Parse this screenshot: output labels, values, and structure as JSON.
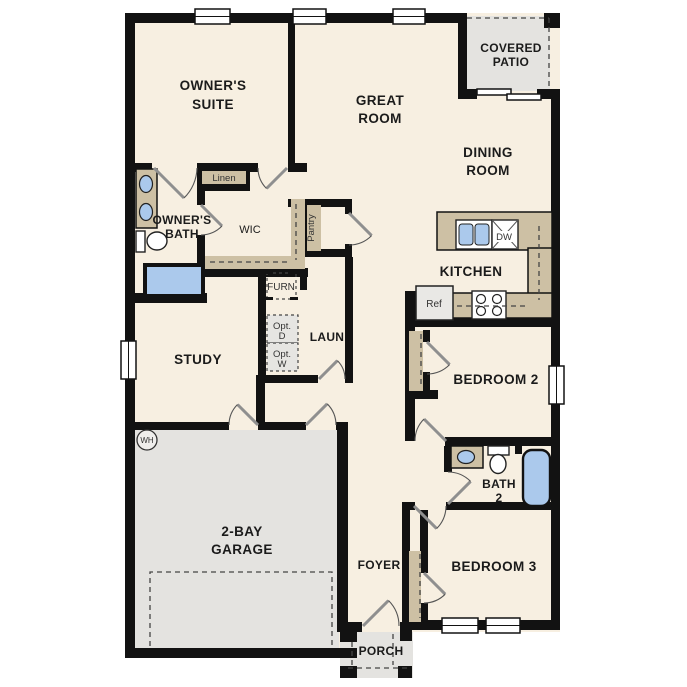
{
  "title": "Single-story residential floor plan",
  "palette": {
    "floor_cream": "#f7efe1",
    "wall_black": "#121212",
    "cabinetry_tan": "#cdc0a4",
    "concrete_gray": "#e4e3e0",
    "water_blue": "#abc9ec"
  },
  "rooms": {
    "owners_suite": [
      "OWNER'S",
      "SUITE"
    ],
    "great_room": [
      "GREAT",
      "ROOM"
    ],
    "covered_patio": [
      "COVERED",
      "PATIO"
    ],
    "dining_room": [
      "DINING",
      "ROOM"
    ],
    "kitchen": "KITCHEN",
    "owners_bath": [
      "OWNER'S",
      "BATH"
    ],
    "wic": "WIC",
    "study": "STUDY",
    "laundry": "LAUN",
    "bedroom2": "BEDROOM 2",
    "bath2": [
      "BATH",
      "2"
    ],
    "bedroom3": "BEDROOM 3",
    "garage": [
      "2-BAY",
      "GARAGE"
    ],
    "foyer": "FOYER",
    "porch": "PORCH"
  },
  "fixtures": {
    "linen": "Linen",
    "pantry": "Pantry",
    "furnace": "FURN",
    "opt_dryer": [
      "Opt.",
      "D"
    ],
    "opt_washer": [
      "Opt.",
      "W"
    ],
    "fridge": "Ref",
    "dishwasher": "DW",
    "water_heater": "WH"
  }
}
